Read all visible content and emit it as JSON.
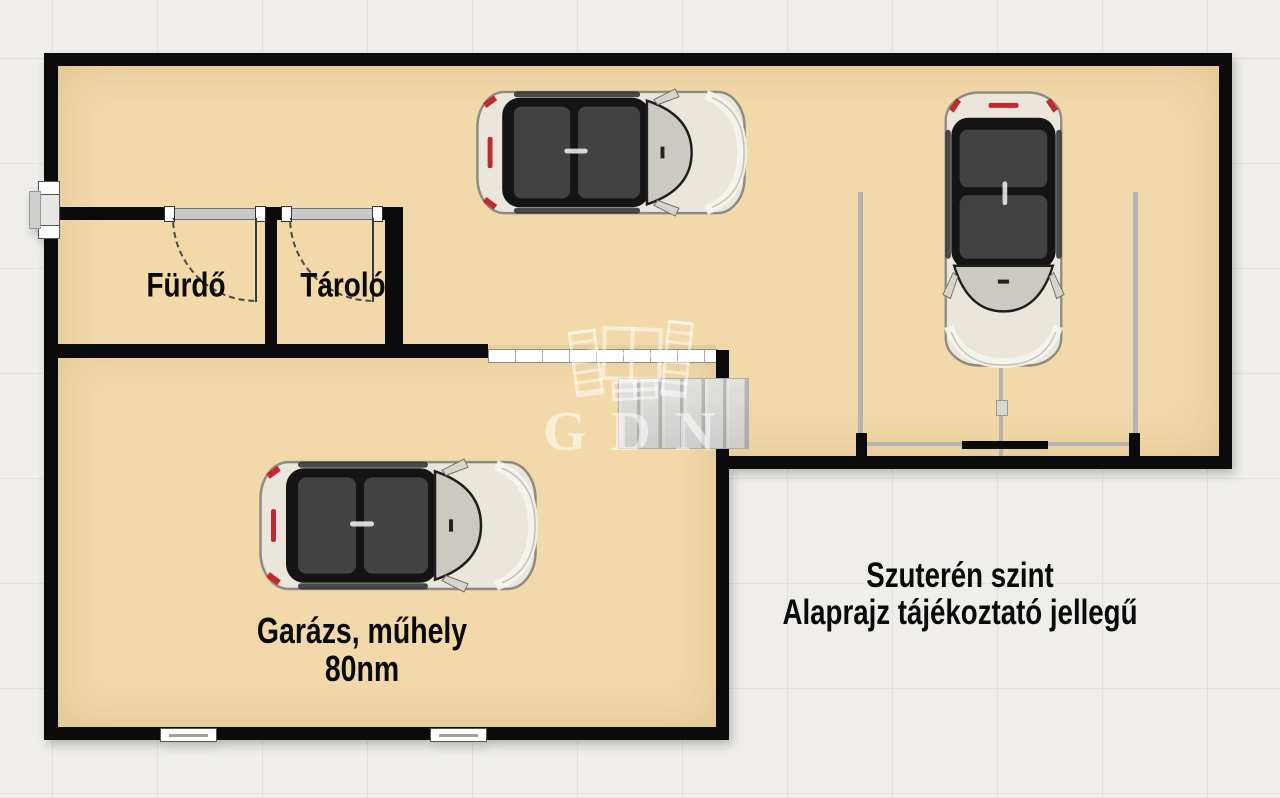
{
  "plan": {
    "rooms": {
      "bathroom": {
        "label": "Fürdő"
      },
      "storage": {
        "label": "Tároló"
      },
      "garage": {
        "label": "Garázs, műhely",
        "area": "80nm"
      }
    },
    "annotation": {
      "line1": "Szuterén szint",
      "line2": "Alaprajz tájékoztató jellegű"
    },
    "watermark": {
      "text": "GDN"
    },
    "cars": [
      {
        "id": "hall-car",
        "location": "upper hall",
        "heading": "east"
      },
      {
        "id": "parking-car",
        "location": "right parking bay",
        "heading": "south"
      },
      {
        "id": "garage-car",
        "location": "garage workshop",
        "heading": "east"
      }
    ],
    "colors": {
      "floor": "#f2d9a9",
      "wall": "#0b0b0b",
      "background": "#efeeeb",
      "accent_red": "#c3282c",
      "door_lintel": "#c8c8c8"
    }
  }
}
